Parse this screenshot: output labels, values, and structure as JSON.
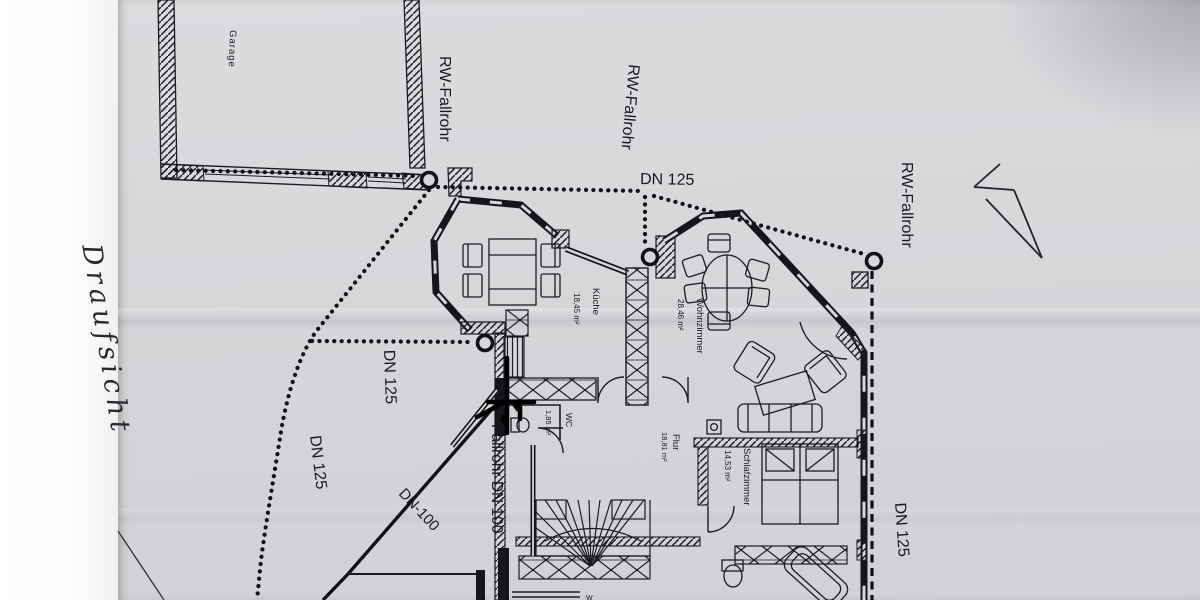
{
  "photo": {
    "description": "Photographed ground-floor architectural plan with hand-marked rainwater downpipe runs",
    "handwritten_note": "Draufsicht",
    "cut_off_label": "W"
  },
  "rooms": {
    "garage": {
      "name": "Garage"
    },
    "kueche": {
      "name": "Küche",
      "area": "18,45 m²"
    },
    "wohnzimmer": {
      "name": "Wohnzimmer",
      "area": "28,46 m²"
    },
    "flur": {
      "name": "Flur",
      "area": "18,81 m²"
    },
    "schlafzimmer": {
      "name": "Schlafzimmer",
      "area": "14,53 m²"
    },
    "wc": {
      "name": "WC",
      "area": "1,85 m²"
    }
  },
  "pipes": {
    "rw_fallrohr_garage": "RW-Fallrohr",
    "rw_fallrohr_mitte": "RW-Fallrohr",
    "rw_fallrohr_rechts": "RW-Fallrohr",
    "dn125_oben": "DN 125",
    "dn125_west": "DN 125",
    "dn125_suedwest": "DN 125",
    "dn125_rechts": "DN 125",
    "dn100_diagonal": "DN-100",
    "fallrohr_dn100": "Fallrohr DN 100"
  },
  "colors": {
    "paper": "#d7d6d9",
    "margin": "#fcfcfb",
    "ink": "#1c1b21"
  }
}
